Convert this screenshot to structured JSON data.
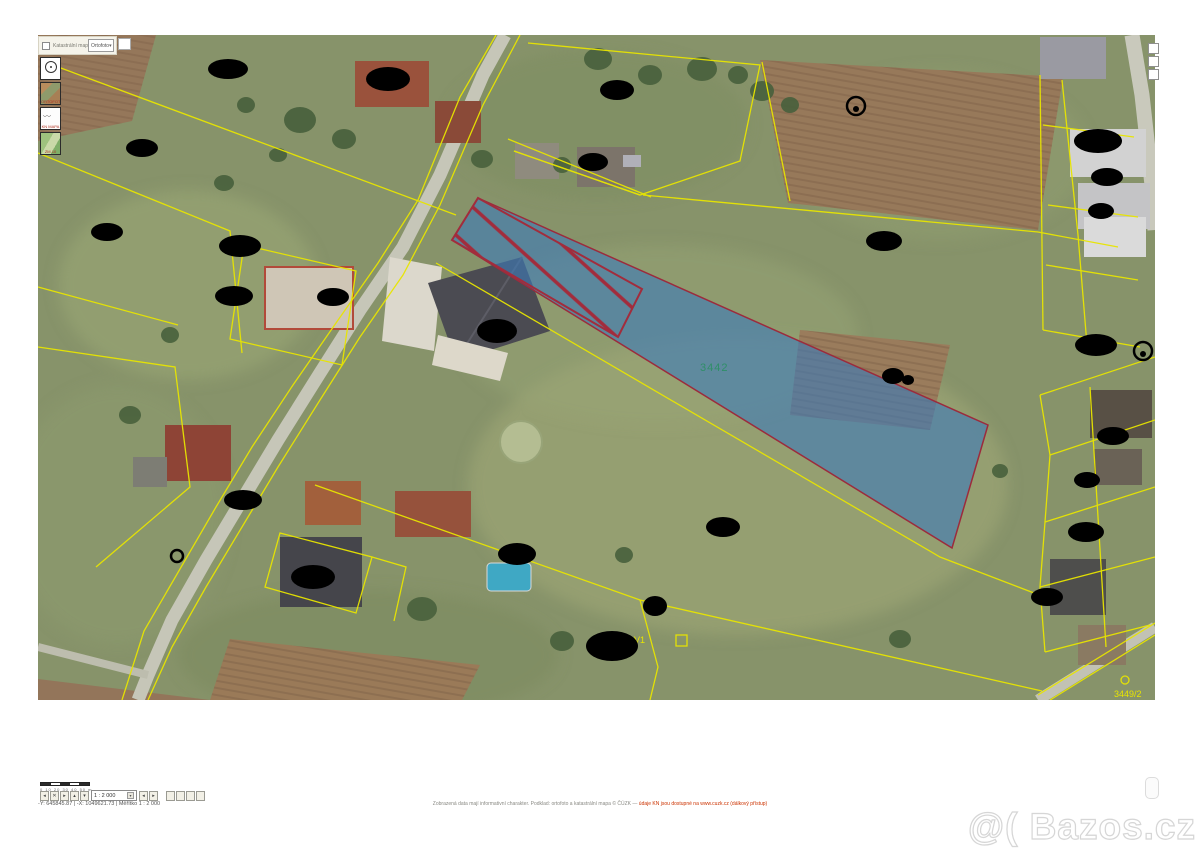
{
  "map": {
    "parcel_label": "3442",
    "small_labels": {
      "v1": "V1",
      "corner": "3449/2"
    },
    "colors": {
      "highlight_fill": "#3d7ab8",
      "highlight_outline": "#a22c3c",
      "cadastre_line": "#e8e500",
      "parcel_label_green": "#2f8f68",
      "redaction": "#000000",
      "road": "#c6c6b8"
    }
  },
  "toolbar": {
    "checkbox_label": "Katastrální mapa",
    "layer_select_value": "Ortofoto",
    "select_arrow": "▾"
  },
  "layer_panel": {
    "buttons": [
      {
        "label": ""
      },
      {
        "label": "ORTOFOTO"
      },
      {
        "label": "KN MAPA"
      },
      {
        "label": "ZM 10"
      }
    ]
  },
  "footer": {
    "scale_ticks": "0   10   20   30   40   50 m",
    "pan_buttons": [
      "◂",
      "✕",
      "▸",
      "▴",
      "▾"
    ],
    "scale_select_value": "1 : 2 000",
    "select_arrow": "▾",
    "history_buttons": [
      "◂",
      "▸"
    ],
    "tool_buttons": [
      "",
      "",
      "",
      ""
    ],
    "status": "-Y: 645845.87 | -X: 1049621.73 | Měřítko 1 : 2 000",
    "disclaimer_text": "Zobrazená data mají informativní charakter. Podklad: ortofoto a katastrální mapa © ČÚZK — ",
    "disclaimer_link": "údaje KN jsou dostupné na www.cuzk.cz (dálkový přístup)"
  },
  "watermark": "@( Bazos.cz"
}
